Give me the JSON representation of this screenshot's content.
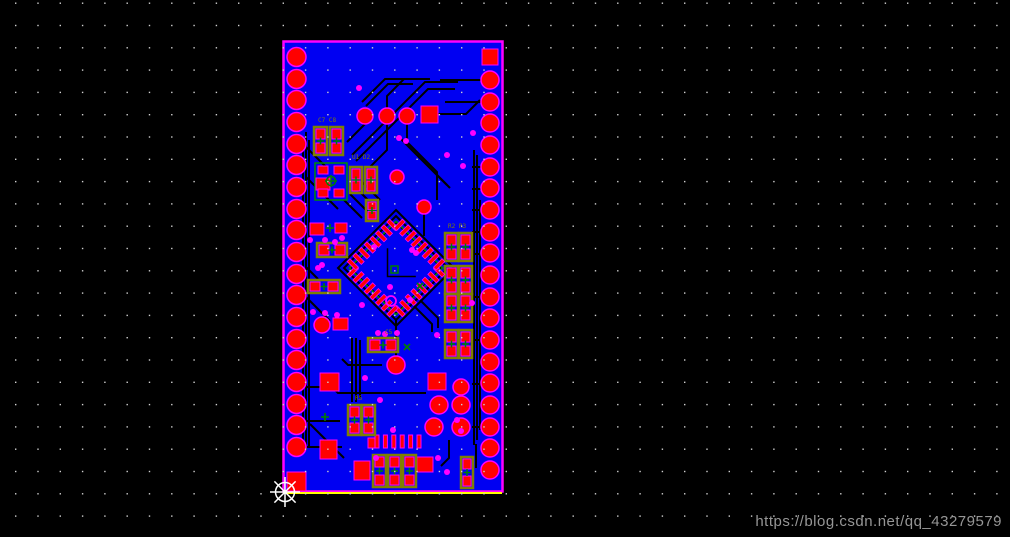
{
  "watermark": {
    "text": "https://blog.csdn.net/qq_43279579"
  },
  "colors": {
    "canvas_bg": "#000000",
    "board_fill": "#0000f2",
    "board_border": "#ff00ff",
    "pad_red": "#ff0000",
    "pad_halo": "#ff00ff",
    "via_magenta": "#ff00ff",
    "trace_black": "#000000",
    "silk_olive": "#7f7f00",
    "silk_green": "#008000",
    "courtyard_green": "#009000",
    "grid_dot": "#d0d0d0",
    "keepout_yellow": "#ffff00",
    "cursor_white": "#ffffff",
    "watermark_gray": "#969696"
  },
  "grid": {
    "spacing": 22.3,
    "offset_x": 15,
    "offset_y": 2.5,
    "dot_size": 1.4
  },
  "board": {
    "x": 283.5,
    "y": 41.5,
    "w": 219,
    "h": 450
  },
  "yellow_line": {
    "x1": 286,
    "y1": 493,
    "x2": 502,
    "y2": 493
  },
  "edge_pads": {
    "left": {
      "cx": 296.5,
      "r": 9.5,
      "ys": [
        57,
        79,
        100,
        122,
        144,
        165,
        187,
        209,
        230,
        252,
        274,
        295,
        317,
        339,
        360,
        382,
        404,
        425,
        447
      ]
    },
    "right": {
      "cx": 490,
      "r": 9,
      "ys": [
        80,
        102,
        123,
        145,
        167,
        188,
        210,
        232,
        253,
        275,
        297,
        318,
        340,
        362,
        383,
        405,
        427,
        448,
        470
      ]
    },
    "left_square": {
      "x": 287,
      "y": 472,
      "w": 19,
      "h": 19
    },
    "right_square": {
      "x": 482,
      "y": 49,
      "w": 16,
      "h": 16
    }
  },
  "qfp": {
    "cx": 396,
    "cy": 268,
    "half_side": 33,
    "rotation": 45,
    "pads_per_side": 8,
    "pad_len": 12,
    "pad_w": 4,
    "pitch": 8,
    "pin1_ring": {
      "cx": 391,
      "cy": 301,
      "r": 5
    },
    "center_mark": {
      "x": 394,
      "y": 269
    }
  },
  "round_pads": [
    [
      365,
      116,
      8
    ],
    [
      387,
      116,
      8
    ],
    [
      407,
      116,
      8
    ],
    [
      397,
      177,
      7
    ],
    [
      424,
      207,
      7
    ],
    [
      322,
      325,
      8
    ],
    [
      396,
      365,
      9
    ],
    [
      461,
      387,
      8
    ],
    [
      439,
      405,
      9
    ],
    [
      461,
      405,
      9
    ],
    [
      434,
      427,
      9
    ],
    [
      461,
      427,
      9
    ]
  ],
  "square_pads": [
    [
      421,
      106,
      17,
      17
    ],
    [
      428,
      373,
      18,
      17
    ],
    [
      320,
      373,
      19,
      18
    ],
    [
      320,
      440,
      17,
      19
    ],
    [
      354,
      461,
      16,
      19
    ],
    [
      417,
      457,
      16,
      15
    ]
  ],
  "bare_rect_pads": [
    [
      310,
      223,
      14,
      12
    ],
    [
      335,
      223,
      12,
      10
    ],
    [
      333,
      318,
      15,
      12
    ],
    [
      368,
      438,
      10,
      10
    ]
  ],
  "bar_row": {
    "x0": 375,
    "y": 435,
    "w": 4,
    "h": 13,
    "step": 8.4,
    "count": 6
  },
  "components_2pad": [
    [
      314,
      127,
      13,
      28
    ],
    [
      330,
      127,
      13,
      28
    ],
    [
      350,
      167,
      12,
      26
    ],
    [
      365,
      167,
      12,
      26
    ],
    [
      366,
      200,
      12,
      21
    ],
    [
      317,
      243,
      30,
      14
    ],
    [
      308,
      280,
      32,
      13
    ],
    [
      445,
      233,
      13,
      28
    ],
    [
      459,
      233,
      13,
      28
    ],
    [
      445,
      266,
      13,
      28
    ],
    [
      459,
      266,
      13,
      28
    ],
    [
      445,
      294,
      13,
      28
    ],
    [
      459,
      294,
      13,
      28
    ],
    [
      445,
      330,
      13,
      28
    ],
    [
      459,
      330,
      13,
      28
    ],
    [
      368,
      338,
      30,
      14
    ],
    [
      348,
      405,
      13,
      30
    ],
    [
      362,
      405,
      13,
      30
    ],
    [
      373,
      455,
      13,
      32
    ],
    [
      388,
      455,
      13,
      32
    ],
    [
      403,
      455,
      13,
      32
    ],
    [
      461,
      457,
      12,
      31
    ]
  ],
  "crystal": {
    "x": 315,
    "y": 163,
    "w": 32,
    "h": 37
  },
  "vias": [
    [
      359,
      88
    ],
    [
      399,
      138
    ],
    [
      406,
      141
    ],
    [
      473,
      133
    ],
    [
      447,
      155
    ],
    [
      463,
      166
    ],
    [
      310,
      240
    ],
    [
      325,
      240
    ],
    [
      335,
      242
    ],
    [
      342,
      238
    ],
    [
      322,
      265
    ],
    [
      318,
      268
    ],
    [
      362,
      305
    ],
    [
      313,
      312
    ],
    [
      325,
      313
    ],
    [
      337,
      315
    ],
    [
      374,
      247
    ],
    [
      412,
      250
    ],
    [
      416,
      253
    ],
    [
      390,
      287
    ],
    [
      410,
      300
    ],
    [
      472,
      303
    ],
    [
      378,
      333
    ],
    [
      385,
      334
    ],
    [
      397,
      333
    ],
    [
      437,
      335
    ],
    [
      365,
      378
    ],
    [
      380,
      400
    ],
    [
      393,
      430
    ],
    [
      438,
      458
    ],
    [
      447,
      472
    ],
    [
      376,
      458
    ],
    [
      457,
      420
    ],
    [
      461,
      431
    ]
  ],
  "green_marks": [
    {
      "x": 325,
      "y": 417,
      "kind": "plus"
    },
    {
      "x": 330,
      "y": 228,
      "kind": "plus"
    },
    {
      "x": 407,
      "y": 347,
      "kind": "x"
    },
    {
      "x": 420,
      "y": 286,
      "kind": "x"
    }
  ],
  "silk_labels": [
    {
      "x": 318,
      "y": 122,
      "text": "C7 C8"
    },
    {
      "x": 352,
      "y": 159,
      "text": "U1 D2"
    },
    {
      "x": 448,
      "y": 228,
      "text": "R2 R3"
    },
    {
      "x": 385,
      "y": 334,
      "text": "C5"
    },
    {
      "x": 355,
      "y": 400,
      "text": "R5"
    }
  ],
  "traces": [
    "M306,132 L306,450",
    "M309,140 L309,446",
    "M303,148 L303,440",
    "M352,155 L425,82 L458,82",
    "M356,161 L428,89 L455,89",
    "M387,108 L387,96 L404,79 L430,79",
    "M438,114 L466,114 L480,100",
    "M413,79 L385,79 L362,102",
    "M413,84 L388,84 L366,106",
    "M365,124 L347,142",
    "M387,124 L387,150 L370,167",
    "M407,124 L407,142 L437,172 L437,200",
    "M400,138 L447,185",
    "M404,142 L450,188",
    "M396,216 L448,268 L396,320 L344,268 Z",
    "M396,210 L454,268 L396,326 L338,268 Z",
    "M396,222 L442,268 L396,314 L350,268 Z",
    "M362,218 L344,200",
    "M368,212 L350,194",
    "M374,206 L356,188",
    "M380,200 L362,182",
    "M420,300 L438,318 L438,328",
    "M414,306 L432,324 L432,332",
    "M306,147 L326,167",
    "M306,177 L338,209",
    "M306,267 L318,279",
    "M306,297 L330,321",
    "M474,150 L474,445",
    "M477,155 L477,440",
    "M480,200 L480,430",
    "M440,80 L481,80",
    "M445,102 L481,102",
    "M472,167 L481,167",
    "M472,189 L481,189",
    "M472,210 L481,210",
    "M472,232 L481,232",
    "M472,254 L481,254",
    "M472,297 L481,297",
    "M472,340 L481,340",
    "M472,384 L481,384",
    "M472,427 L481,427",
    "M306,387 L332,387 L338,393 L426,393",
    "M306,421 L340,421",
    "M306,447 L342,447",
    "M310,424 L344,458",
    "M352,338 L352,402",
    "M356,338 L356,402",
    "M360,340 L360,398",
    "M449,440 L449,458 L441,466",
    "M476,444 L476,468",
    "M424,214 L424,236",
    "M396,320 L396,356",
    "M382,365 L348,365 L342,359"
  ],
  "cursor": {
    "x": 285,
    "y": 492,
    "circle_r": 9.5,
    "arm": 15
  }
}
